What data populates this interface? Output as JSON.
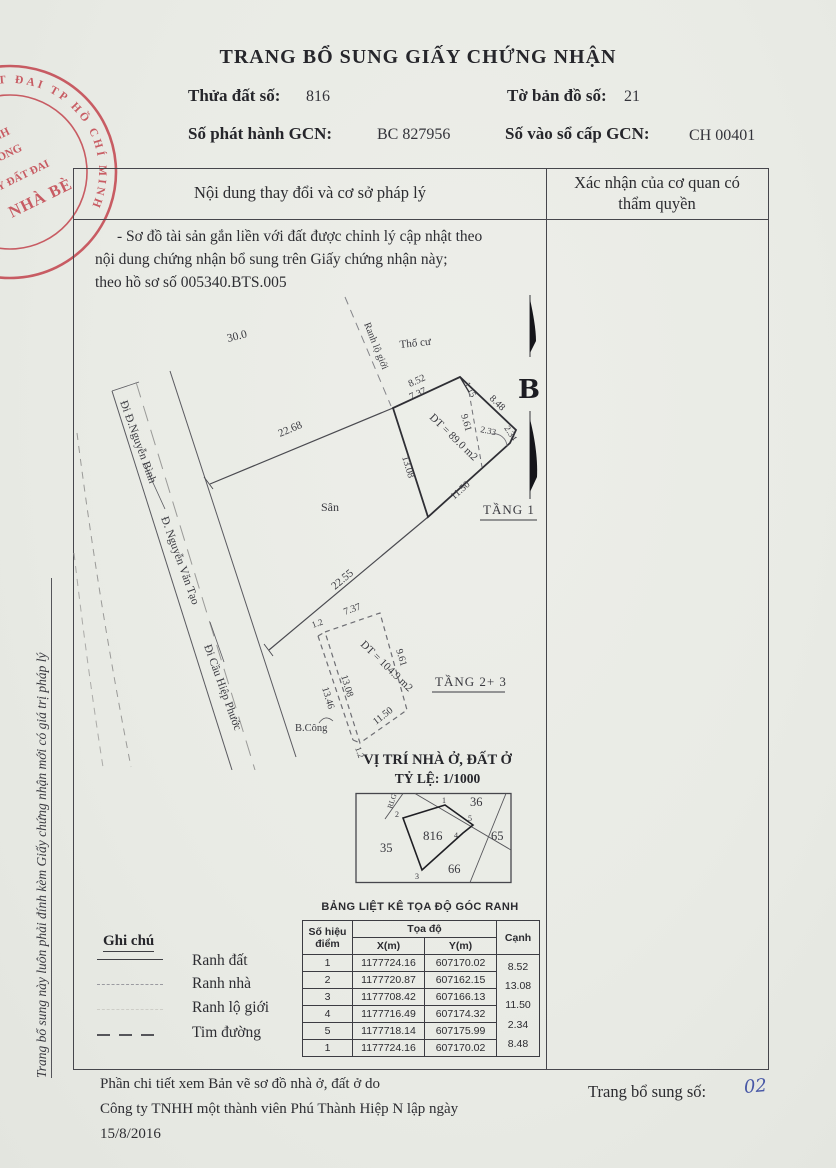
{
  "page": {
    "title": "TRANG BỔ SUNG GIẤY CHỨNG NHẬN",
    "side_note": "Trang bổ sung này luôn phải đính kèm Giấy chứng nhận mới có giá trị pháp lý",
    "fields": {
      "thua_dat_label": "Thửa đất số:",
      "thua_dat_value": "816",
      "to_ban_do_label": "Tờ bản đồ số:",
      "to_ban_do_value": "21",
      "so_phat_hanh_label": "Số phát hành GCN:",
      "so_phat_hanh_value": "BC 827956",
      "so_vao_so_label": "Số vào sổ cấp GCN:",
      "so_vao_so_value": "CH 00401"
    }
  },
  "stamp": {
    "arc_text": "ĐẤT ĐAI TP HỒ CHÍ MINH",
    "line1": "HÁNH",
    "line2": "PHÒNG",
    "line3": "KÝ ĐẤT ĐAI",
    "line4": "NHÀ BÈ",
    "color": "#c13d47"
  },
  "table": {
    "header_left": "Nội dung thay đổi và cơ sở pháp lý",
    "header_right_line1": "Xác nhận của cơ quan có",
    "header_right_line2": "thẩm quyền",
    "note_line1": "- Sơ đồ tài sản gắn liền với đất được chỉnh lý cập nhật theo",
    "note_line2": "nội dung chứng nhận bổ sung trên Giấy chứng nhận này;",
    "note_line3": "theo hồ sơ số 005340.BTS.005"
  },
  "plan": {
    "dim_road_frontage": "30.0",
    "dim_north_boundary": "22.68",
    "dim_south_boundary": "22.55",
    "road_binh": "Đi Đ.Nguyễn Bình",
    "road_tao": "Đ. Nguyễn Văn Tạo",
    "road_phuoc": "Đi Cầu Hiệp Phước",
    "ranh_lo_gioi": "Ranh lộ giới",
    "tho_cu": "Thổ cư",
    "san": "Sân",
    "north_letter": "B",
    "floor1_label": "TẦNG 1",
    "floor1_area": "DT = 89.0 m2",
    "f1_d1": "8.52",
    "f1_d2": "7.37",
    "f1_d3": "1.15",
    "f1_d4": "8.48",
    "f1_d5": "9.61",
    "f1_d6": "2.33",
    "f1_d7": "2.34",
    "f1_d8": "11.50",
    "f1_d9": "13.08",
    "floor23_label": "TẦNG 2+ 3",
    "floor23_area": "DT = 104.9 m2",
    "f2_d1": "1.2",
    "f2_d2": "7.37",
    "f2_d3": "9.61",
    "f2_d4": "13.08",
    "f2_d5": "13.46",
    "f2_d6": "11.50",
    "f2_d7": "1.2",
    "balcony": "B.Công"
  },
  "location_map": {
    "title": "VỊ TRÍ NHÀ Ở, ĐẤT Ở",
    "scale": "TỶ LỆ: 1/1000",
    "parcel": "816",
    "rlg": "RLG",
    "p1": "1",
    "p2": "2",
    "p3": "3",
    "p4": "4",
    "p5": "5",
    "n36": "36",
    "n65": "65",
    "n35": "35",
    "n66": "66"
  },
  "coord_table": {
    "title": "BẢNG LIỆT KÊ TỌA ĐỘ GÓC RANH",
    "h_point_1": "Số hiệu",
    "h_point_2": "điểm",
    "h_coord": "Tọa độ",
    "h_x": "X(m)",
    "h_y": "Y(m)",
    "h_edge": "Cạnh",
    "rows": [
      [
        "1",
        "1177724.16",
        "607170.02"
      ],
      [
        "2",
        "1177720.87",
        "607162.15"
      ],
      [
        "3",
        "1177708.42",
        "607166.13"
      ],
      [
        "4",
        "1177716.49",
        "607174.32"
      ],
      [
        "5",
        "1177718.14",
        "607175.99"
      ],
      [
        "1",
        "1177724.16",
        "607170.02"
      ]
    ],
    "edges": [
      "8.52",
      "13.08",
      "11.50",
      "2.34",
      "8.48"
    ]
  },
  "legend": {
    "title": "Ghi chú",
    "item1": "Ranh đất",
    "item2": "Ranh nhà",
    "item3": "Ranh lộ giới",
    "item4": "Tim đường"
  },
  "footer": {
    "detail_line1": "Phần chi tiết xem Bản vẽ sơ đồ nhà ở, đất ở do",
    "detail_line2": "Công ty TNHH một thành viên Phú Thành Hiệp N lập ngày",
    "detail_line3": "15/8/2016",
    "page_label": "Trang bổ sung số:",
    "page_number": "02"
  }
}
